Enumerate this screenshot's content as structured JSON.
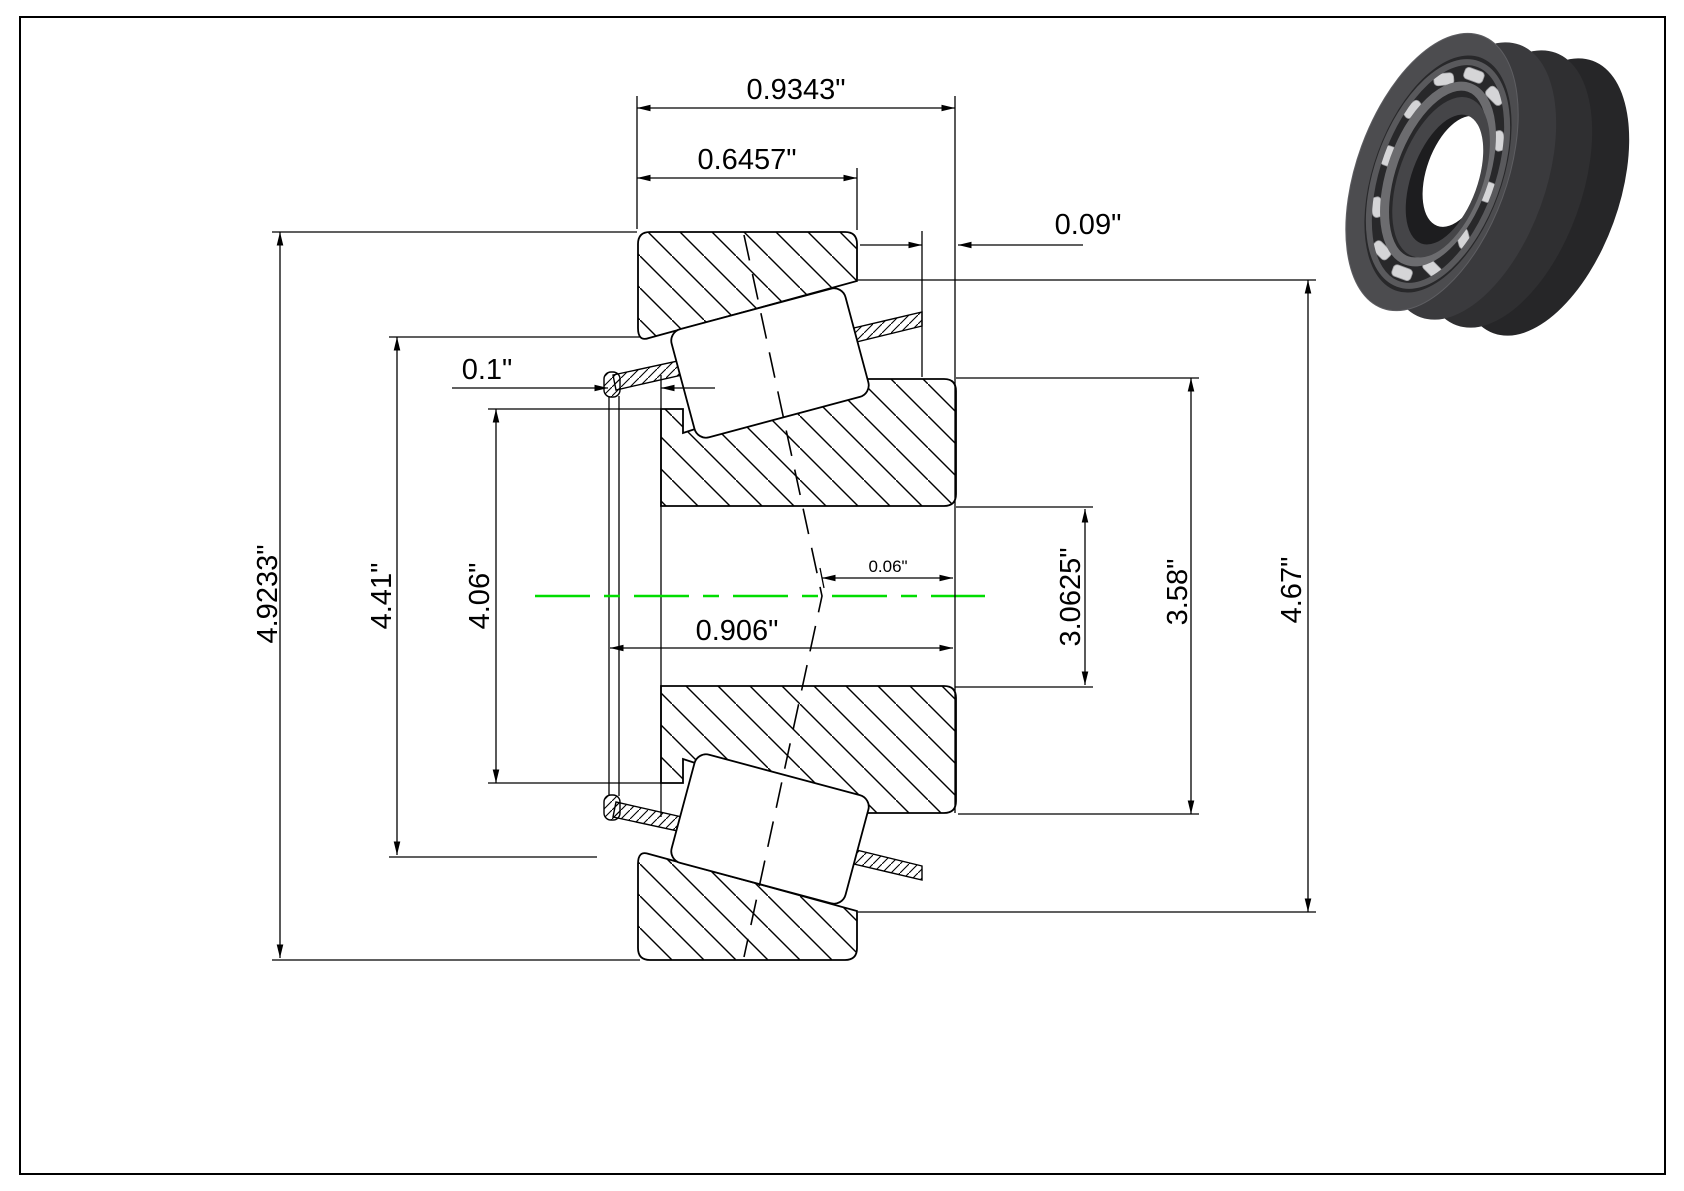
{
  "drawing": {
    "kind": "tapered roller bearing cross-section",
    "dims": {
      "overall_width": "0.9343\"",
      "cup_width": "0.6457\"",
      "stickout_back": "0.09\"",
      "stickout_front": "0.1\"",
      "load_center": "0.06\"",
      "cone_width": "0.906\"",
      "od_a": "4.9233\"",
      "od_b": "4.41\"",
      "od_c": "4.06\"",
      "bore": "3.0625\"",
      "id_b": "3.58\"",
      "od_d": "4.67\""
    },
    "colors": {
      "centerline": "#00dd00",
      "line": "#000000"
    }
  }
}
